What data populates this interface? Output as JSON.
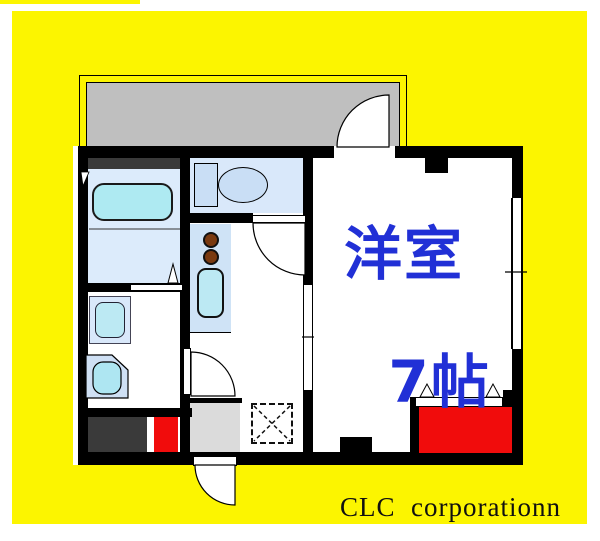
{
  "page": {
    "background": "#ffffff",
    "mat_color": "#fcf500"
  },
  "floorplan": {
    "wall_color": "#000000",
    "balcony_fill": "#bfbfbf",
    "room_fill_light_blue": "#d9e8fa",
    "kitchen_counter_fill": "#cfe3f6",
    "water_fixture_fill": "#aeeaf2",
    "fixture_fill": "#c9def5",
    "entrance_fill": "#dbdbdb",
    "dark_cabinet_fill": "#3a3a3a",
    "accent_red": "#f10c0c",
    "main_room": {
      "label_line1": "洋室",
      "label_line2": "7帖",
      "label_color": "#2130d6"
    },
    "fixtures": [
      "balcony",
      "balcony-door",
      "bathtub",
      "bath-folding-door",
      "washing-machine-pan",
      "vanity-basin",
      "toilet",
      "kitchen-stove-burners",
      "kitchen-sink",
      "sliding-door",
      "window",
      "closet-hanger-shelf",
      "entrance",
      "entrance-door",
      "shoe-cabinet"
    ]
  },
  "footer": {
    "company_name": "CLC  corporationn"
  }
}
